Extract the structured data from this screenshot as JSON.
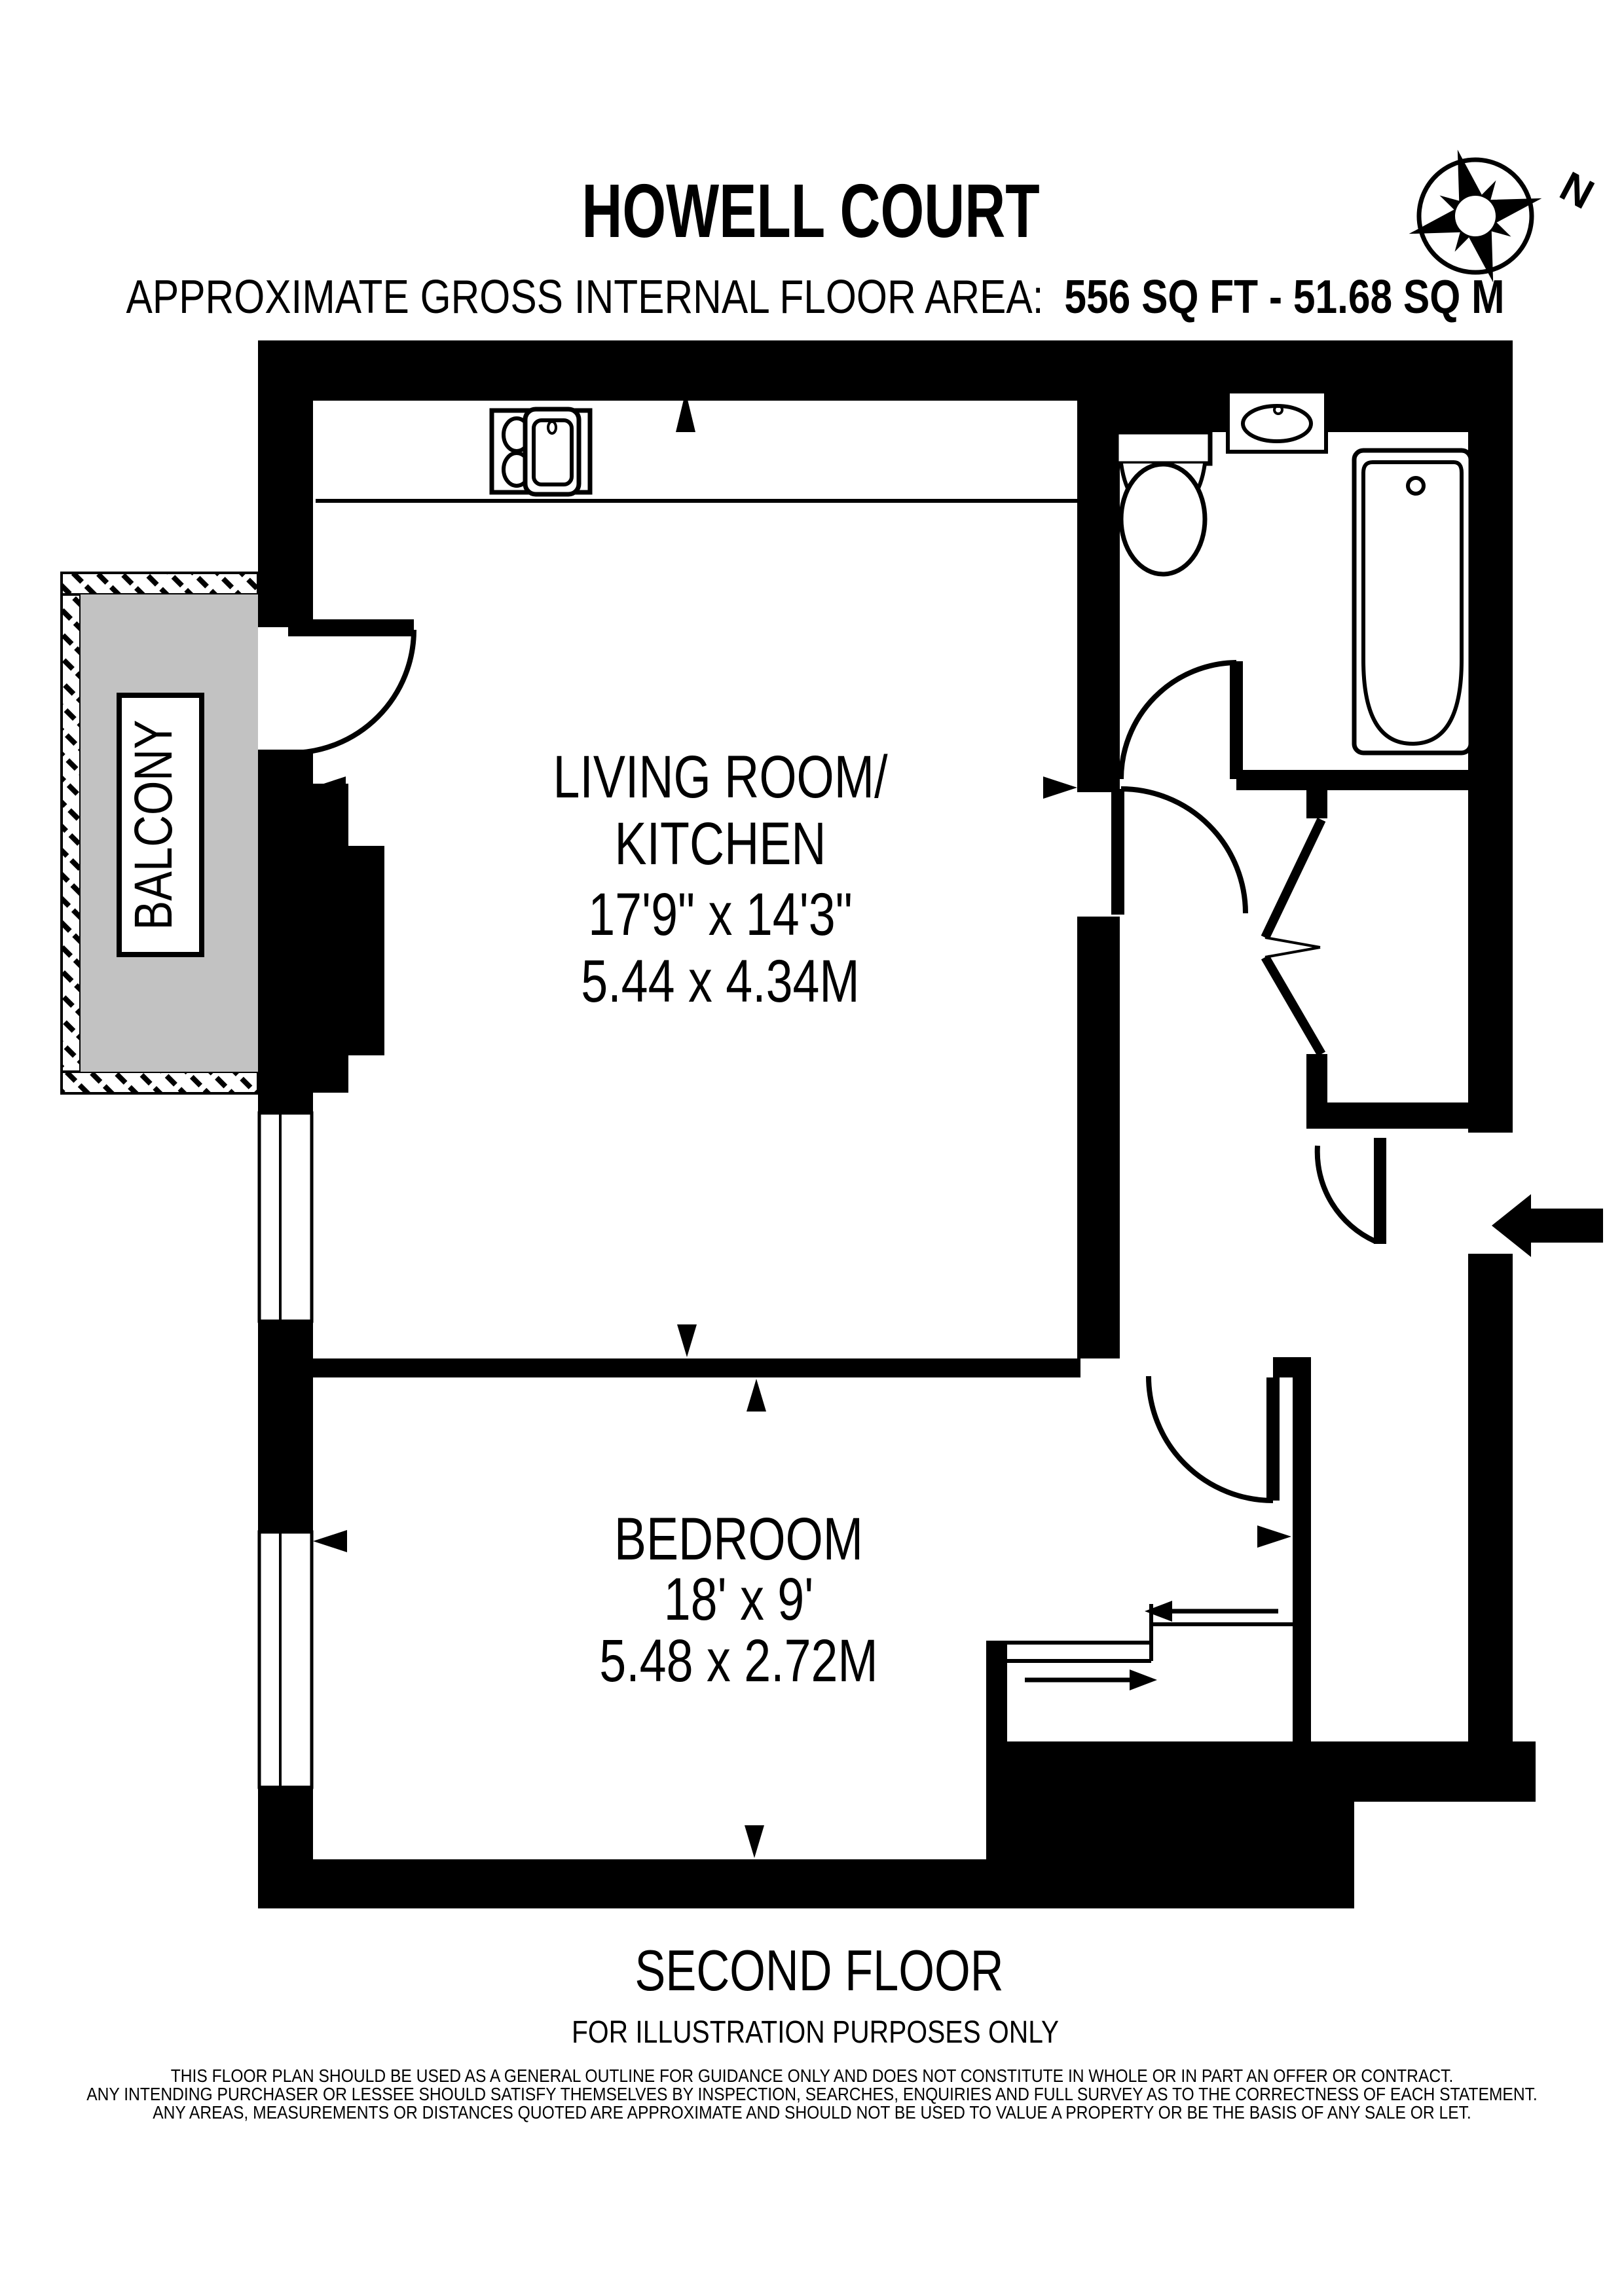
{
  "title": "HOWELL COURT",
  "subtitle": {
    "label": "APPROXIMATE GROSS INTERNAL FLOOR AREA:",
    "value": "556 SQ FT  -  51.68 SQ M"
  },
  "compass": {
    "north_label": "N"
  },
  "rooms": {
    "living_kitchen": {
      "name_line1": "LIVING ROOM/",
      "name_line2": "KITCHEN",
      "dims_imperial": "17'9\" x 14'3\"",
      "dims_metric": "5.44 x 4.34M"
    },
    "bedroom": {
      "name": "BEDROOM",
      "dims_imperial": "18' x 9'",
      "dims_metric": "5.48 x 2.72M"
    },
    "balcony": {
      "label": "BALCONY"
    }
  },
  "footer": {
    "floor_label": "SECOND FLOOR",
    "note": "FOR ILLUSTRATION PURPOSES ONLY",
    "disclaimer": [
      "THIS FLOOR PLAN SHOULD BE USED AS A GENERAL OUTLINE FOR GUIDANCE ONLY AND DOES NOT CONSTITUTE IN WHOLE OR IN PART AN OFFER OR CONTRACT.",
      "ANY INTENDING PURCHASER OR LESSEE SHOULD SATISFY THEMSELVES BY INSPECTION, SEARCHES, ENQUIRIES AND FULL SURVEY AS TO THE CORRECTNESS OF EACH STATEMENT.",
      "ANY AREAS, MEASUREMENTS OR DISTANCES QUOTED ARE APPROXIMATE AND SHOULD NOT BE USED TO VALUE A PROPERTY OR BE THE BASIS OF ANY SALE OR LET."
    ]
  },
  "colors": {
    "wall": "#000000",
    "balcony_fill": "#c2c2c2",
    "background": "#ffffff"
  }
}
